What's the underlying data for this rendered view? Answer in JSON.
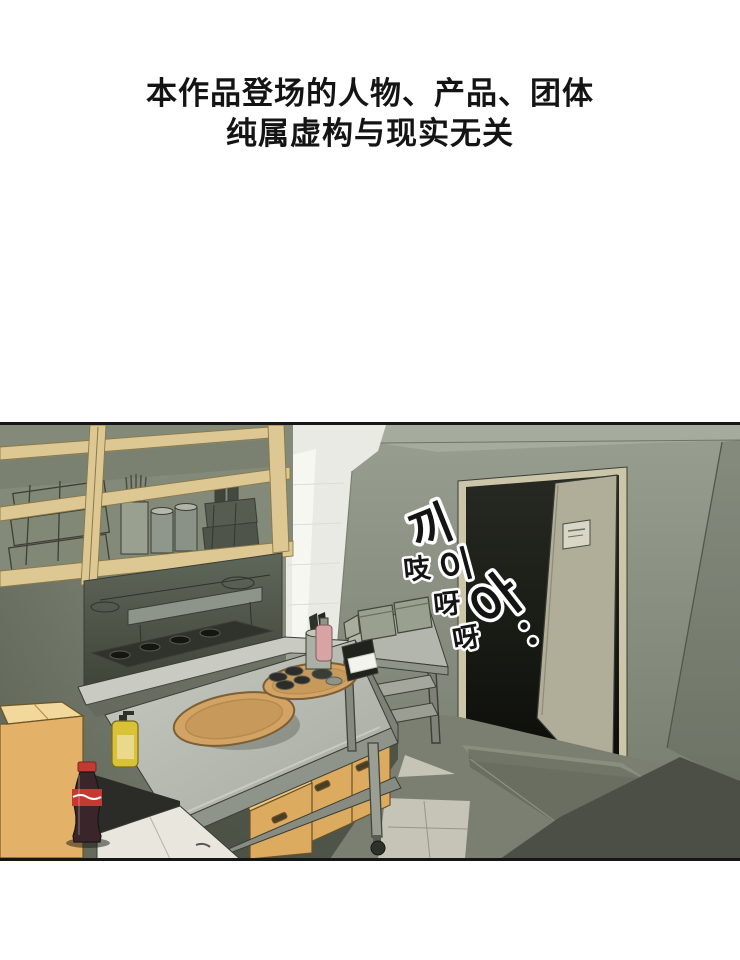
{
  "disclaimer": {
    "line1": "本作品登场的人物、产品、团体",
    "line2": "纯属虚构与现实无关"
  },
  "sfx": {
    "korean": [
      "끼",
      "이",
      "아"
    ],
    "chinese": [
      "吱",
      "呀",
      "呀"
    ]
  },
  "colors": {
    "text": "#141414",
    "wall": "#919788",
    "wall_top": "#a6ac9d",
    "wood": "#ddc893",
    "shelf_back": "#838a79",
    "tile_white": "#eaeae4",
    "beam": "#f7f7f2",
    "window_dark": "#555c50",
    "sill": "#c9cac1",
    "door_frame": "#cbc5aa",
    "door_dark": "#181a12",
    "door_panel": "#b0ad99",
    "door_sign": "#d9d6c5",
    "table_top": "#bcc0b7",
    "table_face": "#8f948a",
    "tray": "#d2a364",
    "dish_dark": "#2c2d28",
    "crate": "#dcab60",
    "cardboard": "#e3b167",
    "counter_dark": "#2b2b27",
    "cabinet_white": "#e9e7dd",
    "cola_body": "#39252a",
    "cola_red": "#c23a31",
    "soap_yellow": "#d9c235",
    "napkin_white": "#f4f4ef",
    "container_gray": "#9aa08f",
    "floor_light": "#c6c4b7",
    "floor_dark": "#4b4f45",
    "sfx_fill": "#141414",
    "sfx_stroke": "#ffffff"
  }
}
